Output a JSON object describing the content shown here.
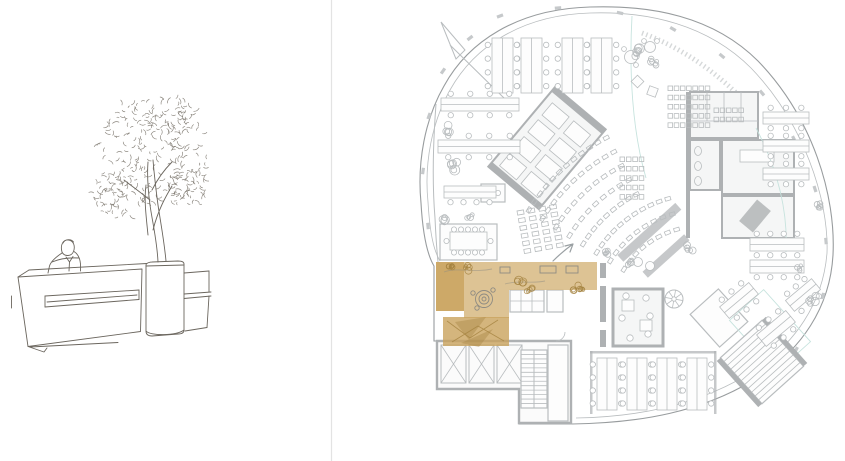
{
  "colors": {
    "paper": "#ffffff",
    "divider": "#e3e3e3",
    "sketch": "#6b665e",
    "sketch_soft": "#7d786f",
    "line": "#b9bdbf",
    "wall": "#aeb1b3",
    "wall_dark": "#989c9e",
    "teal": "#c7e3de",
    "highlight": "#d7b881",
    "highlight_dark": "#c9a25d",
    "highlight_ink": "#a4823f"
  },
  "sketch": {
    "seed": 7,
    "foliage_clusters": [
      {
        "cx": 152,
        "cy": 152,
        "rx": 55,
        "ry": 56,
        "n": 190
      },
      {
        "cx": 118,
        "cy": 196,
        "rx": 26,
        "ry": 22,
        "n": 55
      },
      {
        "cx": 188,
        "cy": 186,
        "rx": 22,
        "ry": 20,
        "n": 45
      },
      {
        "cx": 170,
        "cy": 118,
        "rx": 26,
        "ry": 22,
        "n": 45
      }
    ]
  },
  "plan": {
    "desks": [
      {
        "x": 492,
        "y": 38,
        "w": 21,
        "h": 55,
        "left": 4,
        "right": 4
      },
      {
        "x": 521,
        "y": 38,
        "w": 21,
        "h": 55,
        "left": 4,
        "right": 4
      },
      {
        "x": 562,
        "y": 38,
        "w": 21,
        "h": 55,
        "left": 4,
        "right": 4
      },
      {
        "x": 591,
        "y": 38,
        "w": 21,
        "h": 55,
        "left": 4,
        "right": 4
      },
      {
        "x": 441,
        "y": 98,
        "w": 78,
        "h": 13,
        "top": 4,
        "bottom": 4
      },
      {
        "x": 438,
        "y": 140,
        "w": 82,
        "h": 13,
        "top": 4,
        "bottom": 4
      },
      {
        "x": 444,
        "y": 186,
        "w": 52,
        "h": 12,
        "bottom": 4
      },
      {
        "x": 763,
        "y": 112,
        "w": 46,
        "h": 12,
        "top": 3,
        "bottom": 3
      },
      {
        "x": 763,
        "y": 140,
        "w": 46,
        "h": 12,
        "top": 3,
        "bottom": 3
      },
      {
        "x": 763,
        "y": 168,
        "w": 46,
        "h": 12,
        "top": 3,
        "bottom": 3
      },
      {
        "x": 597,
        "y": 358,
        "w": 20,
        "h": 52,
        "left": 4,
        "right": 4
      },
      {
        "x": 627,
        "y": 358,
        "w": 20,
        "h": 52,
        "left": 4,
        "right": 4
      },
      {
        "x": 657,
        "y": 358,
        "w": 20,
        "h": 52,
        "left": 4,
        "right": 4
      },
      {
        "x": 687,
        "y": 358,
        "w": 20,
        "h": 52,
        "left": 4,
        "right": 4
      },
      {
        "x": 750,
        "y": 238,
        "w": 54,
        "h": 13,
        "top": 4,
        "bottom": 4
      },
      {
        "x": 750,
        "y": 260,
        "w": 54,
        "h": 13,
        "bottom": 4
      },
      {
        "x": 720,
        "y": 293,
        "w": 38,
        "h": 15,
        "top": 3,
        "bottom": 3,
        "rot": -40
      },
      {
        "x": 757,
        "y": 321,
        "w": 38,
        "h": 15,
        "top": 3,
        "bottom": 3,
        "rot": -40
      },
      {
        "x": 786,
        "y": 288,
        "w": 34,
        "h": 14,
        "top": 3,
        "bottom": 3,
        "rot": -40
      }
    ],
    "lockers": [
      {
        "x": 668,
        "y": 86,
        "rows": 5,
        "cols": 7,
        "cell": 4.6,
        "gx": 6.2,
        "gy": 9.2
      },
      {
        "x": 714,
        "y": 108,
        "rows": 2,
        "cols": 5,
        "cell": 4.6,
        "gx": 6.2,
        "gy": 9.2
      },
      {
        "x": 620,
        "y": 157,
        "rows": 5,
        "cols": 4,
        "cell": 4.6,
        "gx": 6.4,
        "gy": 9.4
      }
    ],
    "auditorium": {
      "cx": 702,
      "cy": 318,
      "a0": 212,
      "a1": 254,
      "step": 8.6,
      "seat_w": 5.5,
      "seat_h": 3.6,
      "rows": [
        {
          "r": 92
        },
        {
          "r": 108
        },
        {
          "r": 124
        },
        {
          "r": 140,
          "amax": 242
        },
        {
          "r": 156,
          "amax": 242
        },
        {
          "r": 172,
          "amax": 242
        },
        {
          "r": 188,
          "amax": 242
        },
        {
          "r": 204,
          "amax": 242
        }
      ]
    },
    "seat_block": {
      "x": 517,
      "y": 211,
      "cols": 4,
      "rows": 6,
      "dx": 11,
      "dy": 7.8,
      "w": 6.5,
      "h": 4.2,
      "rot": -10
    },
    "elevators": [
      {
        "x": 441,
        "y": 345,
        "w": 25,
        "h": 38
      },
      {
        "x": 469,
        "y": 345,
        "w": 25,
        "h": 38
      },
      {
        "x": 497,
        "y": 345,
        "w": 25,
        "h": 38
      }
    ],
    "stairs": [
      {
        "x": 521,
        "y": 350,
        "w": 26,
        "h": 58,
        "treads": 12,
        "mid": true
      },
      {
        "x": 734,
        "y": 331,
        "w": 56,
        "h": 62,
        "treads": 11,
        "walls": true,
        "rot": -42
      }
    ],
    "spiral": {
      "cx": 674,
      "cy": 299,
      "r": 9
    },
    "plants": [
      {
        "x": 449,
        "y": 129,
        "r": 5
      },
      {
        "x": 452,
        "y": 166,
        "r": 6
      },
      {
        "x": 447,
        "y": 220,
        "r": 5
      },
      {
        "x": 470,
        "y": 216,
        "r": 4
      },
      {
        "x": 639,
        "y": 52,
        "r": 6
      },
      {
        "x": 654,
        "y": 62,
        "r": 4
      },
      {
        "x": 605,
        "y": 253,
        "r": 4
      },
      {
        "x": 690,
        "y": 248,
        "r": 4
      },
      {
        "x": 812,
        "y": 300,
        "r": 5
      },
      {
        "x": 798,
        "y": 268,
        "r": 4
      },
      {
        "x": 630,
        "y": 262,
        "r": 3.5
      },
      {
        "x": 818,
        "y": 205,
        "r": 4
      }
    ],
    "hl_plants": [
      {
        "x": 521,
        "y": 284,
        "r": 5
      },
      {
        "x": 529,
        "y": 289,
        "r": 4
      },
      {
        "x": 575,
        "y": 287,
        "r": 5
      },
      {
        "x": 582,
        "y": 291,
        "r": 3.5
      },
      {
        "x": 468,
        "y": 268,
        "r": 4
      },
      {
        "x": 450,
        "y": 268,
        "r": 3
      }
    ],
    "wall_ticks": [
      {
        "x": 500,
        "y": 16,
        "a": -20
      },
      {
        "x": 558,
        "y": 8,
        "a": -5
      },
      {
        "x": 620,
        "y": 13,
        "a": 12
      },
      {
        "x": 673,
        "y": 29,
        "a": 30
      },
      {
        "x": 722,
        "y": 56,
        "a": 40
      },
      {
        "x": 762,
        "y": 93,
        "a": 50
      },
      {
        "x": 794,
        "y": 139,
        "a": 62
      },
      {
        "x": 815,
        "y": 189,
        "a": 72
      },
      {
        "x": 826,
        "y": 241,
        "a": 85
      },
      {
        "x": 823,
        "y": 296,
        "a": 100
      },
      {
        "x": 796,
        "y": 350,
        "a": 118
      },
      {
        "x": 754,
        "y": 386,
        "a": 130
      },
      {
        "x": 470,
        "y": 38,
        "a": -38
      },
      {
        "x": 443,
        "y": 71,
        "a": -55
      },
      {
        "x": 429,
        "y": 116,
        "a": -70
      },
      {
        "x": 423,
        "y": 171,
        "a": -82
      },
      {
        "x": 428,
        "y": 226,
        "a": -95
      }
    ]
  }
}
